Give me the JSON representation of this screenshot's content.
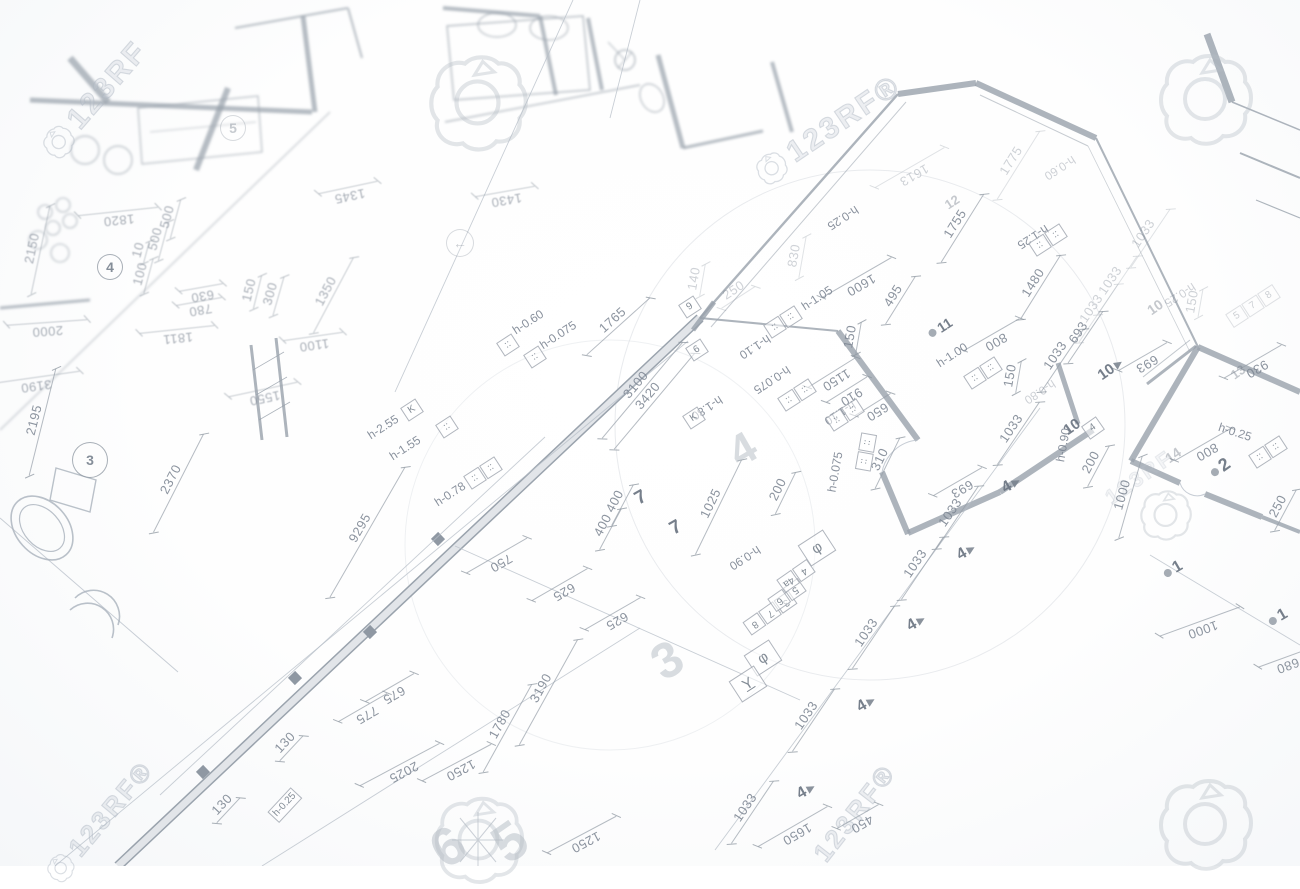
{
  "watermarks": {
    "brand": "123RF",
    "texts": [
      {
        "t": "123RF",
        "x": 95,
        "y": 100,
        "r": -49,
        "s": 30,
        "icon": true
      },
      {
        "t": "123RF®",
        "x": 828,
        "y": 130,
        "r": -34,
        "s": 30,
        "icon": true
      },
      {
        "t": "123RF®",
        "x": 855,
        "y": 813,
        "r": -52,
        "s": 26,
        "icon": false
      },
      {
        "t": "123RF®",
        "x": 100,
        "y": 822,
        "r": -50,
        "s": 26,
        "icon": true
      },
      {
        "t": "123RF",
        "x": 1140,
        "y": 478,
        "r": -35,
        "s": 21,
        "icon": false,
        "cls": "xf"
      }
    ],
    "icons": [
      {
        "x": 477,
        "y": 103,
        "s": 105
      },
      {
        "x": 1205,
        "y": 100,
        "s": 100
      },
      {
        "x": 1165,
        "y": 515,
        "s": 55
      },
      {
        "x": 478,
        "y": 840,
        "s": 95
      },
      {
        "x": 1205,
        "y": 825,
        "s": 100
      }
    ]
  },
  "plan": {
    "labels": [
      {
        "t": "9295",
        "x": 367,
        "y": 532,
        "r": -60,
        "c": "dim",
        "len": 150
      },
      {
        "t": "750",
        "x": 497,
        "y": 556,
        "r": 150,
        "c": "dim",
        "len": 70
      },
      {
        "t": "625",
        "x": 560,
        "y": 585,
        "r": 150,
        "c": "dim",
        "len": 64
      },
      {
        "t": "625",
        "x": 613,
        "y": 614,
        "r": 150,
        "c": "dim",
        "len": 64
      },
      {
        "t": "400",
        "x": 622,
        "y": 505,
        "r": -62,
        "c": "dim",
        "len": 46
      },
      {
        "t": "400",
        "x": 610,
        "y": 529,
        "r": -62,
        "c": "dim",
        "len": 46
      },
      {
        "t": "1025",
        "x": 718,
        "y": 507,
        "r": -64,
        "c": "dim",
        "len": 105
      },
      {
        "t": "3100",
        "x": 642,
        "y": 390,
        "r": -50,
        "c": "dim",
        "len": 125
      },
      {
        "t": "3420",
        "x": 654,
        "y": 401,
        "r": -50,
        "c": "dim",
        "len": 125
      },
      {
        "t": "1765",
        "x": 618,
        "y": 326,
        "r": -42,
        "c": "dim",
        "len": 85
      },
      {
        "t": "2195",
        "x": 42,
        "y": 422,
        "r": -76,
        "c": "dim",
        "len": 110
      },
      {
        "t": "2370",
        "x": 178,
        "y": 483,
        "r": -63,
        "c": "dim",
        "len": 110
      },
      {
        "t": "3190",
        "x": 35,
        "y": 378,
        "r": 172,
        "c": "dim bz",
        "len": 90
      },
      {
        "t": "2000",
        "x": 47,
        "y": 323,
        "r": 176,
        "c": "dim bz",
        "len": 80
      },
      {
        "t": "1550",
        "x": 263,
        "y": 390,
        "r": 168,
        "c": "dim bz",
        "len": 70
      },
      {
        "t": "1100",
        "x": 313,
        "y": 337,
        "r": 172,
        "c": "dim bz",
        "len": 60
      },
      {
        "t": "1811",
        "x": 177,
        "y": 330,
        "r": 174,
        "c": "dim bz",
        "len": 75
      },
      {
        "t": "780",
        "x": 199,
        "y": 302,
        "r": 170,
        "c": "dim bz",
        "len": 46
      },
      {
        "t": "630",
        "x": 201,
        "y": 288,
        "r": 170,
        "c": "dim bz",
        "len": 44
      },
      {
        "t": "150",
        "x": 257,
        "y": 292,
        "r": -76,
        "c": "dim bz",
        "len": 34
      },
      {
        "t": "300",
        "x": 278,
        "y": 296,
        "r": -74,
        "c": "dim bz",
        "len": 40
      },
      {
        "t": "1350",
        "x": 333,
        "y": 295,
        "r": -62,
        "c": "dim bz",
        "len": 85
      },
      {
        "t": "1345",
        "x": 348,
        "y": 188,
        "r": 168,
        "c": "dim f bz",
        "len": 60
      },
      {
        "t": "1430",
        "x": 505,
        "y": 192,
        "r": 170,
        "c": "dim f bz",
        "len": 60
      },
      {
        "t": "2150",
        "x": 40,
        "y": 250,
        "r": -78,
        "c": "dim bz",
        "len": 90
      },
      {
        "t": "1820",
        "x": 118,
        "y": 212,
        "r": 174,
        "c": "dim bz",
        "len": 80
      },
      {
        "t": "500",
        "x": 175,
        "y": 219,
        "r": -75,
        "c": "dim bz",
        "len": 40
      },
      {
        "t": "500",
        "x": 163,
        "y": 241,
        "r": -75,
        "c": "dim bz",
        "len": 40
      },
      {
        "t": "10",
        "x": 146,
        "y": 252,
        "r": -75,
        "c": "dim bz",
        "len": 22
      },
      {
        "t": "100",
        "x": 148,
        "y": 276,
        "r": -75,
        "c": "dim bz",
        "len": 36
      },
      {
        "t": "1150",
        "x": 832,
        "y": 373,
        "r": 148,
        "c": "dim",
        "len": 56
      },
      {
        "t": "910",
        "x": 847,
        "y": 390,
        "r": 148,
        "c": "dim",
        "len": 48
      },
      {
        "t": "650",
        "x": 873,
        "y": 405,
        "r": 148,
        "c": "dim",
        "len": 42
      },
      {
        "t": "310",
        "x": 887,
        "y": 463,
        "r": -64,
        "c": "dim",
        "len": 56
      },
      {
        "t": "200",
        "x": 785,
        "y": 493,
        "r": -64,
        "c": "dim",
        "len": 46
      },
      {
        "t": "495",
        "x": 900,
        "y": 300,
        "r": -58,
        "c": "dim",
        "len": 56
      },
      {
        "t": "800",
        "x": 992,
        "y": 335,
        "r": 150,
        "c": "dim",
        "len": 64
      },
      {
        "t": "693",
        "x": 1085,
        "y": 337,
        "r": -56,
        "c": "dim",
        "len": 62
      },
      {
        "t": "150",
        "x": 858,
        "y": 338,
        "r": -80,
        "c": "dim",
        "len": 32
      },
      {
        "t": "1600",
        "x": 857,
        "y": 278,
        "r": 150,
        "c": "dim",
        "len": 80
      },
      {
        "t": "830",
        "x": 802,
        "y": 257,
        "r": -80,
        "c": "dim f",
        "len": 42
      },
      {
        "t": "1613",
        "x": 910,
        "y": 168,
        "r": 150,
        "c": "dim f",
        "len": 80
      },
      {
        "t": "1775",
        "x": 1018,
        "y": 165,
        "r": -58,
        "c": "dim f",
        "len": 80
      },
      {
        "t": "1755",
        "x": 962,
        "y": 228,
        "r": -58,
        "c": "dim",
        "len": 80
      },
      {
        "t": "1480",
        "x": 1040,
        "y": 287,
        "r": -58,
        "c": "dim",
        "len": 75
      },
      {
        "t": "250",
        "x": 738,
        "y": 297,
        "r": -33,
        "c": "dim f",
        "len": 40
      },
      {
        "t": "140",
        "x": 702,
        "y": 280,
        "r": -80,
        "c": "dim f",
        "len": 32
      },
      {
        "t": "693",
        "x": 1143,
        "y": 357,
        "r": 150,
        "c": "dim",
        "len": 56
      },
      {
        "t": "930",
        "x": 1253,
        "y": 362,
        "r": 150,
        "c": "dim",
        "len": 66
      },
      {
        "t": "800",
        "x": 1203,
        "y": 445,
        "r": 150,
        "c": "dim",
        "len": 64
      },
      {
        "t": "200",
        "x": 1098,
        "y": 466,
        "r": -62,
        "c": "dim",
        "len": 46
      },
      {
        "t": "1000",
        "x": 1130,
        "y": 497,
        "r": -74,
        "c": "dim",
        "len": 85
      },
      {
        "t": "250",
        "x": 1285,
        "y": 510,
        "r": -62,
        "c": "dim",
        "len": 46
      },
      {
        "t": "150",
        "x": 1018,
        "y": 377,
        "r": -80,
        "c": "dim",
        "len": 32
      },
      {
        "t": "1033",
        "x": 1062,
        "y": 360,
        "r": -56,
        "c": "dim",
        "len": 75
      },
      {
        "t": "693",
        "x": 958,
        "y": 482,
        "r": 150,
        "c": "dim",
        "len": 56
      },
      {
        "t": "1033",
        "x": 1018,
        "y": 433,
        "r": -56,
        "c": "dim",
        "len": 75
      },
      {
        "t": "1033",
        "x": 957,
        "y": 517,
        "r": -56,
        "c": "dim",
        "len": 75
      },
      {
        "t": "1033",
        "x": 922,
        "y": 568,
        "r": -56,
        "c": "dim",
        "len": 75
      },
      {
        "t": "1033",
        "x": 873,
        "y": 637,
        "r": -56,
        "c": "dim",
        "len": 75
      },
      {
        "t": "1033",
        "x": 813,
        "y": 720,
        "r": -56,
        "c": "dim",
        "len": 75
      },
      {
        "t": "1033",
        "x": 752,
        "y": 812,
        "r": -56,
        "c": "dim",
        "len": 75
      },
      {
        "t": "1650",
        "x": 793,
        "y": 827,
        "r": 150,
        "c": "dim",
        "len": 80
      },
      {
        "t": "450",
        "x": 858,
        "y": 817,
        "r": 150,
        "c": "dim",
        "len": 48
      },
      {
        "t": "1000",
        "x": 1200,
        "y": 622,
        "r": 160,
        "c": "dim",
        "len": 85
      },
      {
        "t": "680",
        "x": 1285,
        "y": 658,
        "r": 160,
        "c": "dim",
        "len": 56
      },
      {
        "t": "675",
        "x": 390,
        "y": 688,
        "r": 150,
        "c": "dim",
        "len": 56
      },
      {
        "t": "775",
        "x": 363,
        "y": 708,
        "r": 150,
        "c": "dim",
        "len": 56
      },
      {
        "t": "130",
        "x": 291,
        "y": 748,
        "r": -47,
        "c": "dim",
        "len": 34
      },
      {
        "t": "130",
        "x": 228,
        "y": 810,
        "r": -47,
        "c": "dim",
        "len": 34
      },
      {
        "t": "2025",
        "x": 400,
        "y": 765,
        "r": 152,
        "c": "dim",
        "len": 90
      },
      {
        "t": "1250",
        "x": 457,
        "y": 763,
        "r": 152,
        "c": "dim",
        "len": 78
      },
      {
        "t": "1780",
        "x": 507,
        "y": 728,
        "r": -61,
        "c": "dim",
        "len": 100
      },
      {
        "t": "3190",
        "x": 548,
        "y": 692,
        "r": -61,
        "c": "dim",
        "len": 120
      },
      {
        "t": "1250",
        "x": 582,
        "y": 835,
        "r": 152,
        "c": "dim",
        "len": 78
      },
      {
        "t": "1033",
        "x": 1150,
        "y": 238,
        "r": -56,
        "c": "dim f",
        "len": 70
      },
      {
        "t": "1033",
        "x": 1117,
        "y": 285,
        "r": -56,
        "c": "dim f",
        "len": 70
      },
      {
        "t": "1033",
        "x": 1098,
        "y": 313,
        "r": -56,
        "c": "dim f",
        "len": 70
      },
      {
        "t": "150",
        "x": 1200,
        "y": 303,
        "r": -80,
        "c": "dim f",
        "len": 28
      },
      {
        "t": "h-2.55",
        "x": 383,
        "y": 427,
        "r": -33,
        "c": "hl"
      },
      {
        "t": "h-1.55",
        "x": 405,
        "y": 448,
        "r": -33,
        "c": "hl"
      },
      {
        "t": "h-0.78",
        "x": 450,
        "y": 494,
        "r": -33,
        "c": "hl"
      },
      {
        "t": "h-1.80",
        "x": 707,
        "y": 408,
        "r": 147,
        "c": "hl"
      },
      {
        "t": "h-1.10",
        "x": 755,
        "y": 347,
        "r": 147,
        "c": "hl"
      },
      {
        "t": "h-1.05",
        "x": 817,
        "y": 298,
        "r": -33,
        "c": "hl"
      },
      {
        "t": "h-0.075",
        "x": 772,
        "y": 380,
        "r": 147,
        "c": "hl"
      },
      {
        "t": "h-1.10",
        "x": 840,
        "y": 413,
        "r": 147,
        "c": "hl"
      },
      {
        "t": "h-0.075",
        "x": 835,
        "y": 472,
        "r": -80,
        "c": "hl"
      },
      {
        "t": "h-1.00",
        "x": 952,
        "y": 355,
        "r": -33,
        "c": "hl"
      },
      {
        "t": "h-0.25",
        "x": 843,
        "y": 218,
        "r": 147,
        "c": "hl"
      },
      {
        "t": "h-1.25",
        "x": 1033,
        "y": 237,
        "r": 147,
        "c": "hl"
      },
      {
        "t": "h-0.60",
        "x": 528,
        "y": 322,
        "r": -33,
        "c": "hl"
      },
      {
        "t": "h-0.075",
        "x": 558,
        "y": 335,
        "r": -33,
        "c": "hl"
      },
      {
        "t": "h-0.60",
        "x": 1060,
        "y": 168,
        "r": 147,
        "c": "hl f"
      },
      {
        "t": "h-0.80",
        "x": 1040,
        "y": 392,
        "r": 147,
        "c": "hl f"
      },
      {
        "t": "h-0.25",
        "x": 1235,
        "y": 432,
        "r": 18,
        "c": "hl"
      },
      {
        "t": "h-0.90",
        "x": 1063,
        "y": 445,
        "r": -80,
        "c": "hl"
      },
      {
        "t": "h-0.90",
        "x": 745,
        "y": 558,
        "r": 147,
        "c": "hl"
      },
      {
        "t": "h-0.25",
        "x": 1180,
        "y": 295,
        "r": 147,
        "c": "hl f"
      },
      {
        "t": "7",
        "x": 641,
        "y": 498,
        "r": -30,
        "c": "mk",
        "s": 19
      },
      {
        "t": "7",
        "x": 676,
        "y": 528,
        "r": -30,
        "c": "mk",
        "s": 19
      },
      {
        "t": "11",
        "x": 940,
        "y": 328,
        "r": -33,
        "c": "mk dot",
        "s": 14
      },
      {
        "t": "12",
        "x": 952,
        "y": 202,
        "r": -33,
        "c": "mk f",
        "s": 13
      },
      {
        "t": "10",
        "x": 1072,
        "y": 427,
        "r": -35,
        "c": "mk",
        "s": 15
      },
      {
        "t": "10",
        "x": 1112,
        "y": 368,
        "r": -35,
        "c": "mk tri",
        "s": 15
      },
      {
        "t": "10",
        "x": 1155,
        "y": 307,
        "r": -35,
        "c": "mk f",
        "s": 14
      },
      {
        "t": "2",
        "x": 1220,
        "y": 468,
        "r": -35,
        "c": "mk dot",
        "s": 18
      },
      {
        "t": "14",
        "x": 1173,
        "y": 455,
        "r": -35,
        "c": "mk f",
        "s": 14
      },
      {
        "t": "13",
        "x": 1238,
        "y": 372,
        "r": -35,
        "c": "mk f",
        "s": 13
      },
      {
        "t": "4",
        "x": 1013,
        "y": 484,
        "r": -30,
        "c": "mk tri",
        "s": 16
      },
      {
        "t": "4",
        "x": 968,
        "y": 551,
        "r": -30,
        "c": "mk tri",
        "s": 16
      },
      {
        "t": "4",
        "x": 918,
        "y": 622,
        "r": -30,
        "c": "mk tri",
        "s": 16
      },
      {
        "t": "4",
        "x": 868,
        "y": 703,
        "r": -30,
        "c": "mk tri",
        "s": 16
      },
      {
        "t": "4",
        "x": 808,
        "y": 790,
        "r": -30,
        "c": "mk tri",
        "s": 16
      },
      {
        "t": "1",
        "x": 1173,
        "y": 570,
        "r": -30,
        "c": "mk dot",
        "s": 16
      },
      {
        "t": "1",
        "x": 1278,
        "y": 618,
        "r": -30,
        "c": "mk dot",
        "s": 16
      },
      {
        "t": "6",
        "x": 448,
        "y": 847,
        "r": -35,
        "c": "big",
        "s": 54
      },
      {
        "t": "5",
        "x": 510,
        "y": 842,
        "r": -35,
        "c": "big",
        "s": 54
      },
      {
        "t": "3",
        "x": 667,
        "y": 660,
        "r": -30,
        "c": "big",
        "s": 50
      },
      {
        "t": "4",
        "x": 743,
        "y": 450,
        "r": -30,
        "c": "big",
        "s": 44
      }
    ],
    "boxes": [
      {
        "cells": [
          "9"
        ],
        "x": 690,
        "y": 307,
        "r": -33
      },
      {
        "cells": [
          "6"
        ],
        "x": 697,
        "y": 350,
        "r": -33
      },
      {
        "cells": [
          "4"
        ],
        "x": 1093,
        "y": 428,
        "r": -35
      },
      {
        "cells": [
          "K"
        ],
        "x": 412,
        "y": 410,
        "r": -33
      },
      {
        "cells": [
          "K"
        ],
        "x": 694,
        "y": 418,
        "r": -33
      },
      {
        "cells": [
          "φ"
        ],
        "x": 763,
        "y": 658,
        "r": -33,
        "cls": "lg"
      },
      {
        "cells": [
          "Y"
        ],
        "x": 748,
        "y": 684,
        "r": -33,
        "cls": "lg ul"
      },
      {
        "cells": [
          "φ"
        ],
        "x": 817,
        "y": 548,
        "r": -33,
        "cls": "lg"
      },
      {
        "cells": [
          "h-0.25"
        ],
        "x": 285,
        "y": 805,
        "r": -47
      },
      {
        "cells": [
          "::"
        ],
        "x": 447,
        "y": 427,
        "r": -33
      },
      {
        "cells": [
          "::",
          "::"
        ],
        "x": 483,
        "y": 473,
        "r": -33
      },
      {
        "cells": [
          "::",
          "::"
        ],
        "x": 783,
        "y": 322,
        "r": -33
      },
      {
        "cells": [
          "::",
          "::"
        ],
        "x": 797,
        "y": 395,
        "r": -33
      },
      {
        "cells": [
          "::",
          "::"
        ],
        "x": 845,
        "y": 415,
        "r": -33
      },
      {
        "cells": [
          "::",
          "::"
        ],
        "x": 866,
        "y": 452,
        "r": -80
      },
      {
        "cells": [
          "::",
          "::"
        ],
        "x": 983,
        "y": 373,
        "r": -33
      },
      {
        "cells": [
          "::",
          "::"
        ],
        "x": 1048,
        "y": 240,
        "r": -33
      },
      {
        "cells": [
          "::",
          "::"
        ],
        "x": 1268,
        "y": 452,
        "r": -33
      },
      {
        "cells": [
          "::"
        ],
        "x": 508,
        "y": 345,
        "r": -33
      },
      {
        "cells": [
          "::"
        ],
        "x": 535,
        "y": 357,
        "r": -33
      },
      {
        "cells": [
          "5",
          "7",
          "8"
        ],
        "x": 1253,
        "y": 306,
        "r": -33,
        "cls": "f"
      },
      {
        "cells": [
          "3",
          "7",
          "8"
        ],
        "x": 770,
        "y": 613,
        "r": 145
      },
      {
        "cells": [
          "5",
          "6"
        ],
        "x": 787,
        "y": 595,
        "r": 145
      },
      {
        "cells": [
          "4",
          "4a"
        ],
        "x": 796,
        "y": 576,
        "r": 145
      }
    ],
    "circles": [
      {
        "t": "3",
        "x": 90,
        "y": 460,
        "rad": 17
      },
      {
        "t": "4",
        "x": 110,
        "y": 267,
        "rad": 12
      },
      {
        "t": "5",
        "x": 233,
        "y": 128,
        "rad": 12,
        "cls": "f"
      },
      {
        "t": "←",
        "x": 460,
        "y": 243,
        "rad": 13,
        "cls": "f"
      }
    ]
  }
}
